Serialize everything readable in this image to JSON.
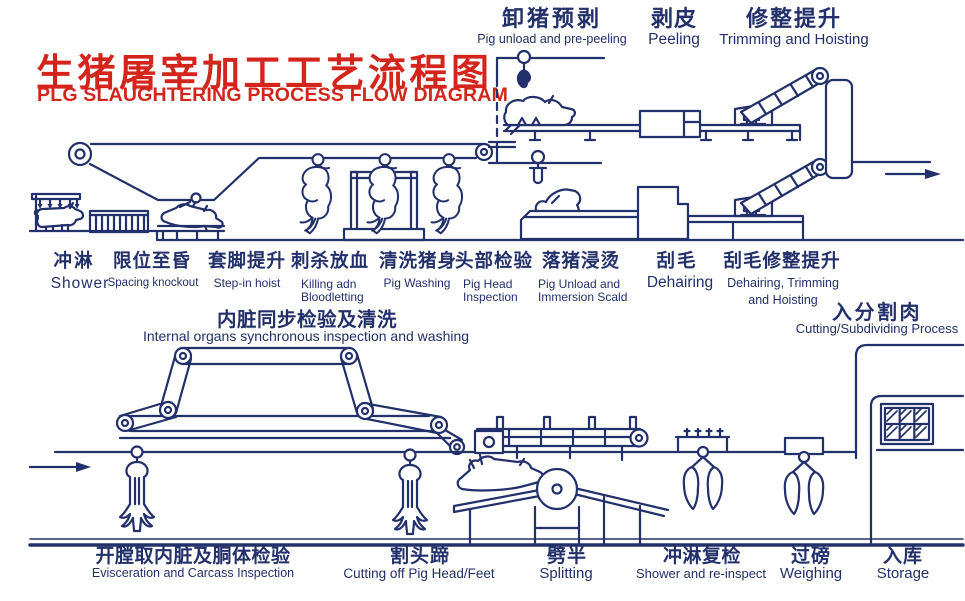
{
  "colors": {
    "ink": "#22306b",
    "red": "#d3251c",
    "bg": "#ffffff"
  },
  "title": {
    "zh": "生猪屠宰加工工艺流程图",
    "en": "PLG SLAUGHTERING PROCESS FLOW DIAGRAM"
  },
  "top_labels": [
    {
      "zh": "卸猪预剥",
      "en": "Pig unload and pre-peeling"
    },
    {
      "zh": "剥皮",
      "en": "Peeling"
    },
    {
      "zh": "修整提升",
      "en": "Trimming and Hoisting"
    }
  ],
  "mid_labels": [
    {
      "zh": "冲淋",
      "en": "Shower"
    },
    {
      "zh": "限位至昏",
      "en": "Spacing knockout"
    },
    {
      "zh": "套脚提升",
      "en": "Step-in hoist"
    },
    {
      "zh": "刺杀放血",
      "en": "Killing adn",
      "en2": "Bloodletting"
    },
    {
      "zh": "清洗猪身",
      "en": "Pig Washing"
    },
    {
      "zh": "头部检验",
      "en": "Pig Head",
      "en2": "Inspection"
    },
    {
      "zh": "落猪浸烫",
      "en": "Pig Unload and",
      "en2": "Immersion Scald"
    },
    {
      "zh": "刮毛",
      "en": "Dehairing"
    },
    {
      "zh": "刮毛修整提升",
      "en": "Dehairing, Trimming",
      "en2": "and Hoisting"
    }
  ],
  "loop_label": {
    "zh": "内脏同步检验及清洗",
    "en": "Internal organs synchronous inspection and washing"
  },
  "cutting_label": {
    "zh": "入分割肉",
    "en": "Cutting/Subdividing Process"
  },
  "bottom_labels": [
    {
      "zh": "开膛取内脏及胴体检验",
      "en": "Evisceration and Carcass Inspection"
    },
    {
      "zh": "割头蹄",
      "en": "Cutting off Pig Head/Feet"
    },
    {
      "zh": "劈半",
      "en": "Splitting"
    },
    {
      "zh": "冲淋复检",
      "en": "Shower and re-inspect"
    },
    {
      "zh": "过磅",
      "en": "Weighing"
    },
    {
      "zh": "入库",
      "en": "Storage"
    }
  ]
}
